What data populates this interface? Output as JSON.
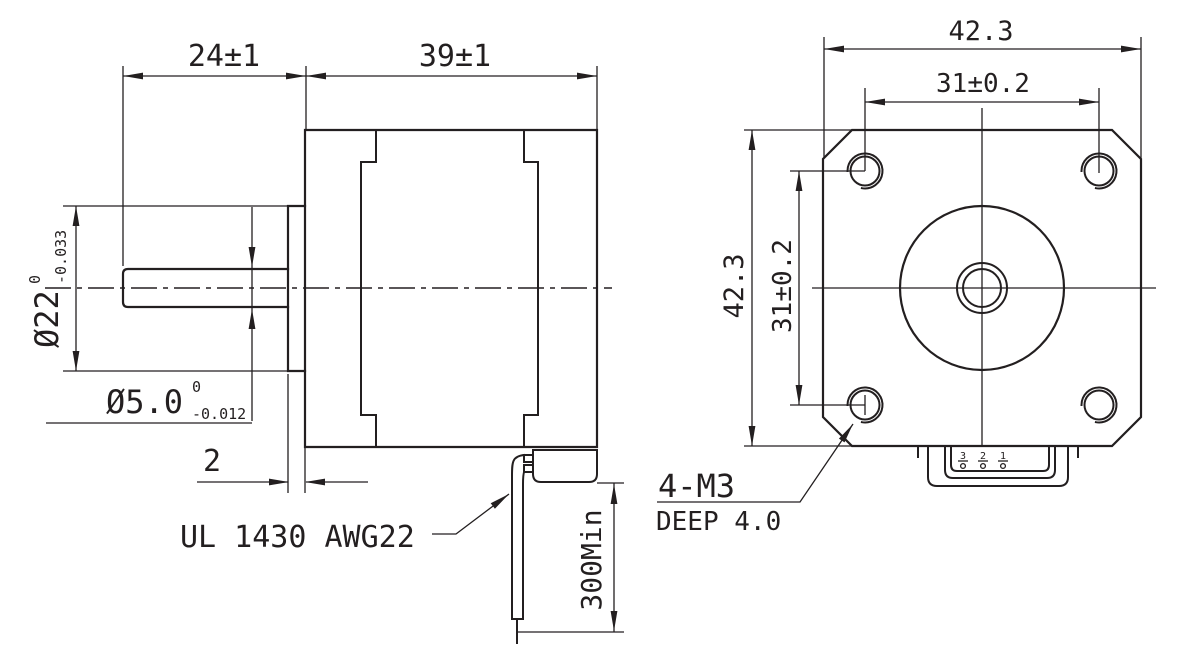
{
  "page": {
    "background": "#ffffff",
    "line_color": "#231f20"
  },
  "side_view": {
    "shaft_length_dim": "24±1",
    "body_length_dim": "39±1",
    "pilot_diameter": {
      "main": "Ø22",
      "upper_tol": "0",
      "lower_tol": "-0.033"
    },
    "shaft_diameter": {
      "main": "Ø5.0",
      "upper_tol": "0",
      "lower_tol": "-0.012"
    },
    "pilot_thickness_dim": "2",
    "lead_wire_label": "UL 1430 AWG22",
    "lead_wire_length_dim": "300Min"
  },
  "front_view": {
    "width_dim": "42.3",
    "height_dim": "42.3",
    "hole_spacing_horizontal_dim": "31±0.2",
    "hole_spacing_vertical_dim": "31±0.2",
    "mounting_hole_note": {
      "line1": "4-M3",
      "line2": "DEEP 4.0"
    },
    "connector_pins": [
      "3",
      "2",
      "1"
    ]
  }
}
